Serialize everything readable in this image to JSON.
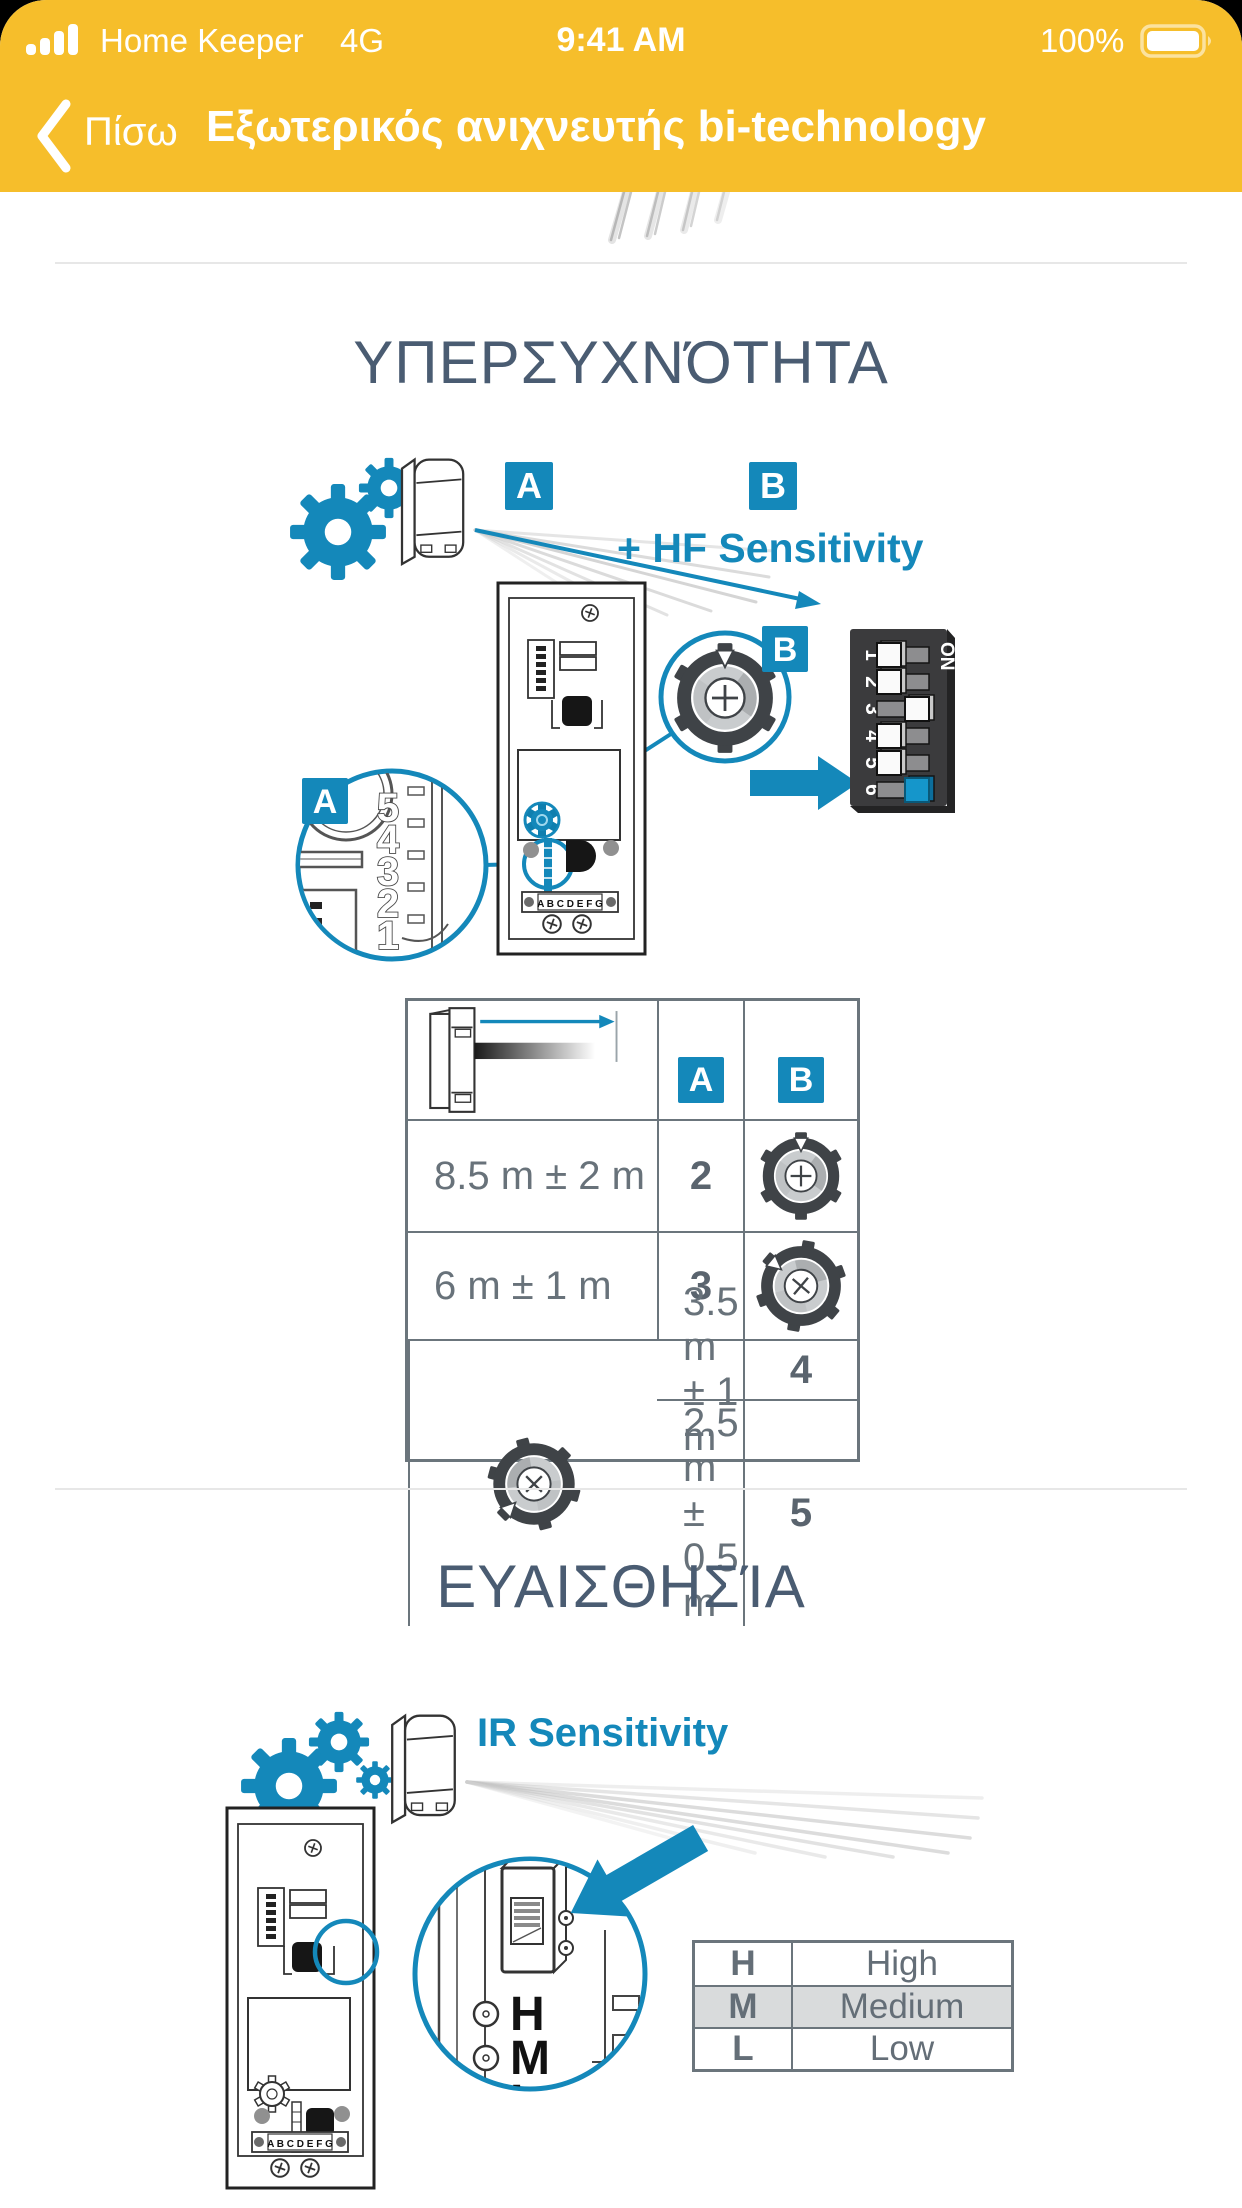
{
  "status_bar": {
    "carrier": "Home Keeper",
    "network": "4G",
    "time": "9:41 AM",
    "battery_level": "100%"
  },
  "nav": {
    "back_label": "Πίσω",
    "title": "Εξωτερικός ανιχνευτής bi-technology"
  },
  "labels": {
    "a": "A",
    "b": "B",
    "terminals": "A B C D E F G"
  },
  "hf": {
    "section_title": "ΥΠΕΡΣΥΧΝΌΤΗΤΑ",
    "caption": "+ HF Sensitivity",
    "dip": {
      "on_label": "ON",
      "numbers": [
        "1",
        "2",
        "3",
        "4",
        "5",
        "6"
      ],
      "states": [
        "off",
        "off",
        "on",
        "off",
        "off",
        "on"
      ],
      "highlighted_switch": "6"
    },
    "scale_numbers": [
      "5",
      "4",
      "3",
      "2",
      "1"
    ],
    "table": {
      "rows": [
        {
          "range": "8.5 m ± 2 m",
          "a": "2"
        },
        {
          "range": "6 m ± 1 m",
          "a": "3"
        },
        {
          "range": "3.5 m ± 1 m",
          "a": "4"
        },
        {
          "range": "2.5 m ± 0.5 m",
          "a": "5"
        }
      ]
    }
  },
  "ir": {
    "section_title": "ΕΥΑΙΣΘΗΣΊΑ",
    "caption": "IR Sensitivity",
    "jumper_labels": [
      "H",
      "M",
      "L"
    ],
    "selected_level": "M",
    "table": {
      "rows": [
        {
          "key": "H",
          "value": "High"
        },
        {
          "key": "M",
          "value": "Medium"
        },
        {
          "key": "L",
          "value": "Low"
        }
      ]
    }
  },
  "colors": {
    "header_yellow": "#F6BE2B",
    "accent_blue": "#1488BA",
    "title_slate": "#4A5C72",
    "table_border": "#6B757C",
    "highlight_row": "#D9DBDC"
  }
}
